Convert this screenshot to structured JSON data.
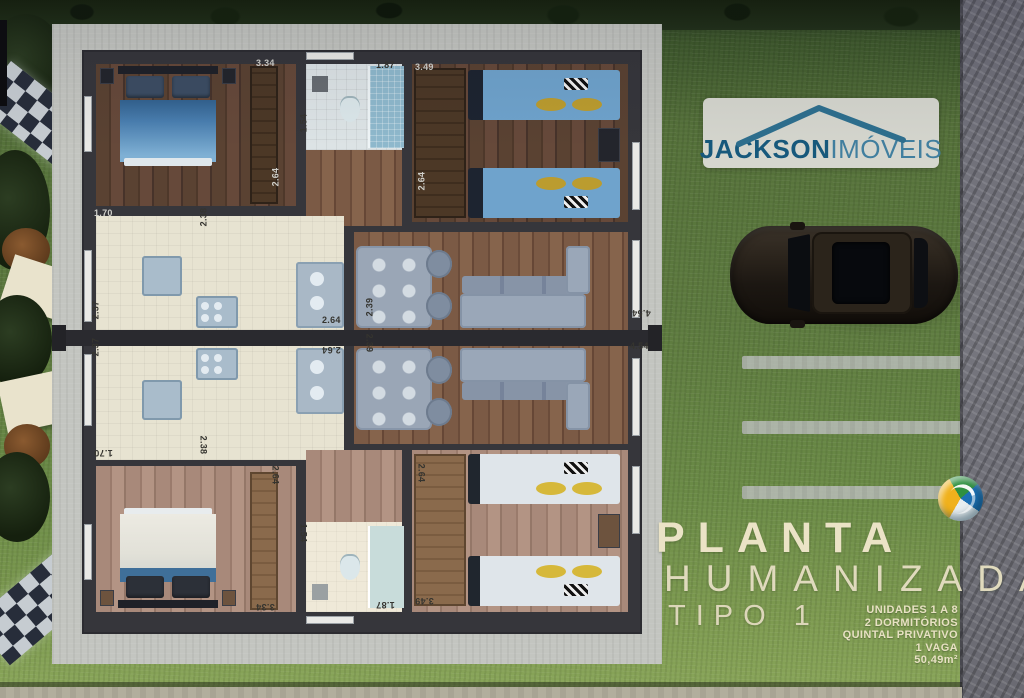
{
  "brand": {
    "name_bold": "JACKSON",
    "name_light": "IMÓVEIS"
  },
  "title": {
    "main": "PLANTA",
    "sub": "HUMANIZADA",
    "type": "TIPO 1"
  },
  "specs": [
    "UNIDADES 1 A 8",
    "2 DORMITÓRIOS",
    "QUINTAL PRIVATIVO",
    "1 VAGA",
    "50,49m²"
  ],
  "colors": {
    "brand_teal": "#2e6f8e",
    "title_cream": "#ebe3c6",
    "grass_green": "#5d7a3c",
    "wall_dark": "#36363b",
    "bed_blue": "#4a7fb0",
    "pillow_gold": "#bb9c2f"
  },
  "plan": {
    "dimension_labels": [
      {
        "t": "3.34",
        "x": 256,
        "y": 58,
        "r": 0,
        "tone": "light"
      },
      {
        "t": "1.87",
        "x": 376,
        "y": 60,
        "r": 0,
        "tone": "dark"
      },
      {
        "t": "3.49",
        "x": 415,
        "y": 62,
        "r": 0,
        "tone": "light"
      },
      {
        "t": "1.54",
        "x": 294,
        "y": 118,
        "r": -90,
        "tone": "dark"
      },
      {
        "t": "2.64",
        "x": 266,
        "y": 172,
        "r": -90,
        "tone": "light"
      },
      {
        "t": "2.64",
        "x": 412,
        "y": 176,
        "r": -90,
        "tone": "light"
      },
      {
        "t": "1.70",
        "x": 94,
        "y": 208,
        "r": 0,
        "tone": "light"
      },
      {
        "t": "2.38",
        "x": 194,
        "y": 212,
        "r": -90,
        "tone": "dark"
      },
      {
        "t": "2.37",
        "x": 86,
        "y": 305,
        "r": -90,
        "tone": "dark"
      },
      {
        "t": "2.64",
        "x": 322,
        "y": 315,
        "r": 0,
        "tone": "dark"
      },
      {
        "t": "2.39",
        "x": 360,
        "y": 302,
        "r": -90,
        "tone": "dark"
      },
      {
        "t": "4.54",
        "x": 632,
        "y": 308,
        "r": 180,
        "tone": "dark"
      },
      {
        "t": "2.37",
        "x": 86,
        "y": 342,
        "r": -90,
        "tone": "dark"
      },
      {
        "t": "2.64",
        "x": 322,
        "y": 345,
        "r": 180,
        "tone": "dark"
      },
      {
        "t": "2.39",
        "x": 360,
        "y": 338,
        "r": 90,
        "tone": "dark"
      },
      {
        "t": "4.54",
        "x": 630,
        "y": 341,
        "r": 0,
        "tone": "dark"
      },
      {
        "t": "1.70",
        "x": 94,
        "y": 448,
        "r": 180,
        "tone": "dark"
      },
      {
        "t": "2.38",
        "x": 194,
        "y": 440,
        "r": 90,
        "tone": "dark"
      },
      {
        "t": "2.64",
        "x": 266,
        "y": 470,
        "r": 90,
        "tone": "dark"
      },
      {
        "t": "2.64",
        "x": 412,
        "y": 468,
        "r": 90,
        "tone": "dark"
      },
      {
        "t": "1.54",
        "x": 294,
        "y": 528,
        "r": 90,
        "tone": "dark"
      },
      {
        "t": "3.34",
        "x": 256,
        "y": 602,
        "r": 180,
        "tone": "dark"
      },
      {
        "t": "1.87",
        "x": 376,
        "y": 600,
        "r": 180,
        "tone": "dark"
      },
      {
        "t": "3.49",
        "x": 415,
        "y": 596,
        "r": 180,
        "tone": "dark"
      }
    ]
  }
}
